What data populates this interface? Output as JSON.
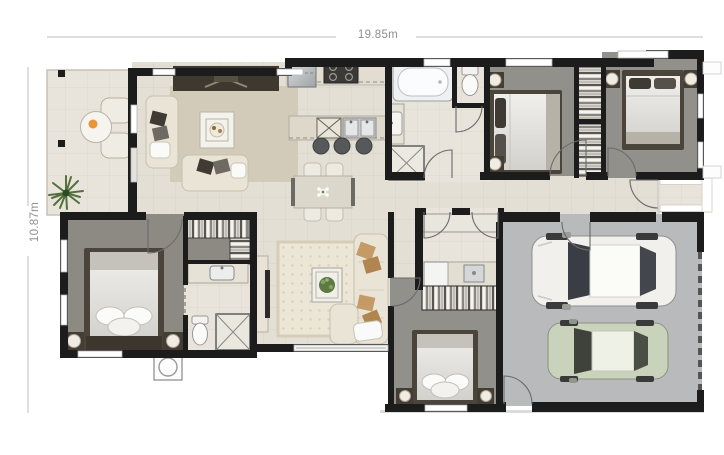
{
  "plan": {
    "name": "house-floor-plan",
    "width_label": "19.85m",
    "height_label": "10.87m"
  },
  "colors": {
    "wall": "#1c1c1c",
    "tile_floor": "#e3dfd5",
    "light_tile": "#e8e4db",
    "carpet": "#92908a",
    "master_carpet": "#8d8a84",
    "garage_floor": "#b9babc",
    "living_rug": "#d2cbba",
    "family_rug": "#ebe5d5",
    "furniture_cream": "#eae4d6",
    "bed_frame": "#4b443a",
    "cushion_tan": "#c49a66",
    "car_white": "#f1f0ed",
    "car_green": "#c9d2ba",
    "dimension_line": "#bdbdbd",
    "dimension_text": "#8f8f8f"
  },
  "rooms": [
    "alfresco-porch",
    "living-room",
    "kitchen",
    "dining",
    "bathroom",
    "wc",
    "bedroom-2",
    "bedroom-3",
    "hallway",
    "entry-porch",
    "garage",
    "laundry",
    "bedroom-4",
    "family-room",
    "walk-in-robe",
    "ensuite",
    "master-bedroom"
  ]
}
